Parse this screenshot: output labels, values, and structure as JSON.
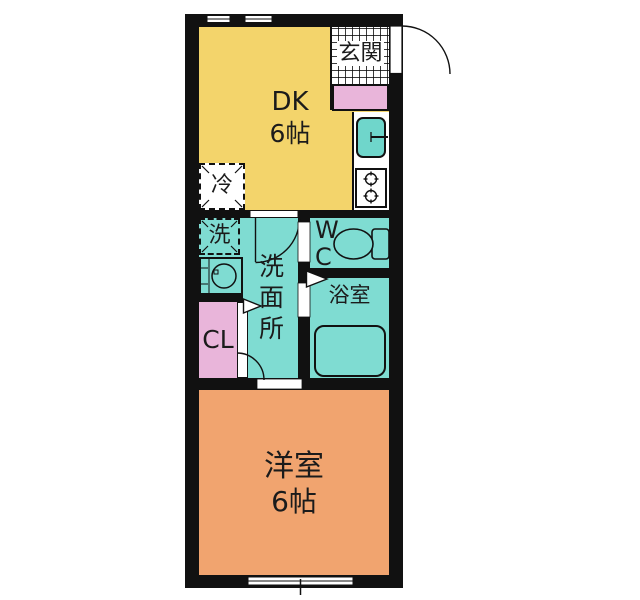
{
  "floor_plan": {
    "rooms": {
      "entrance": {
        "label": "玄関"
      },
      "dining_kitchen": {
        "label": "DK",
        "size": "6帖"
      },
      "refrigerator": {
        "label": "冷"
      },
      "washer": {
        "label": "洗"
      },
      "washroom": {
        "label": "洗面所"
      },
      "toilet": {
        "line1": "W",
        "line2": "C"
      },
      "bathroom": {
        "label": "浴室"
      },
      "closet": {
        "label": "CL"
      },
      "western_room": {
        "label": "洋室",
        "size": "6帖"
      }
    },
    "colors": {
      "wall": "#111111",
      "dk_floor": "#f3d46b",
      "western_floor": "#f1a46f",
      "wet_area_floor": "#7fdcd2",
      "closet_pink": "#e9b5da",
      "sink_teal": "#6fd6cb"
    }
  }
}
